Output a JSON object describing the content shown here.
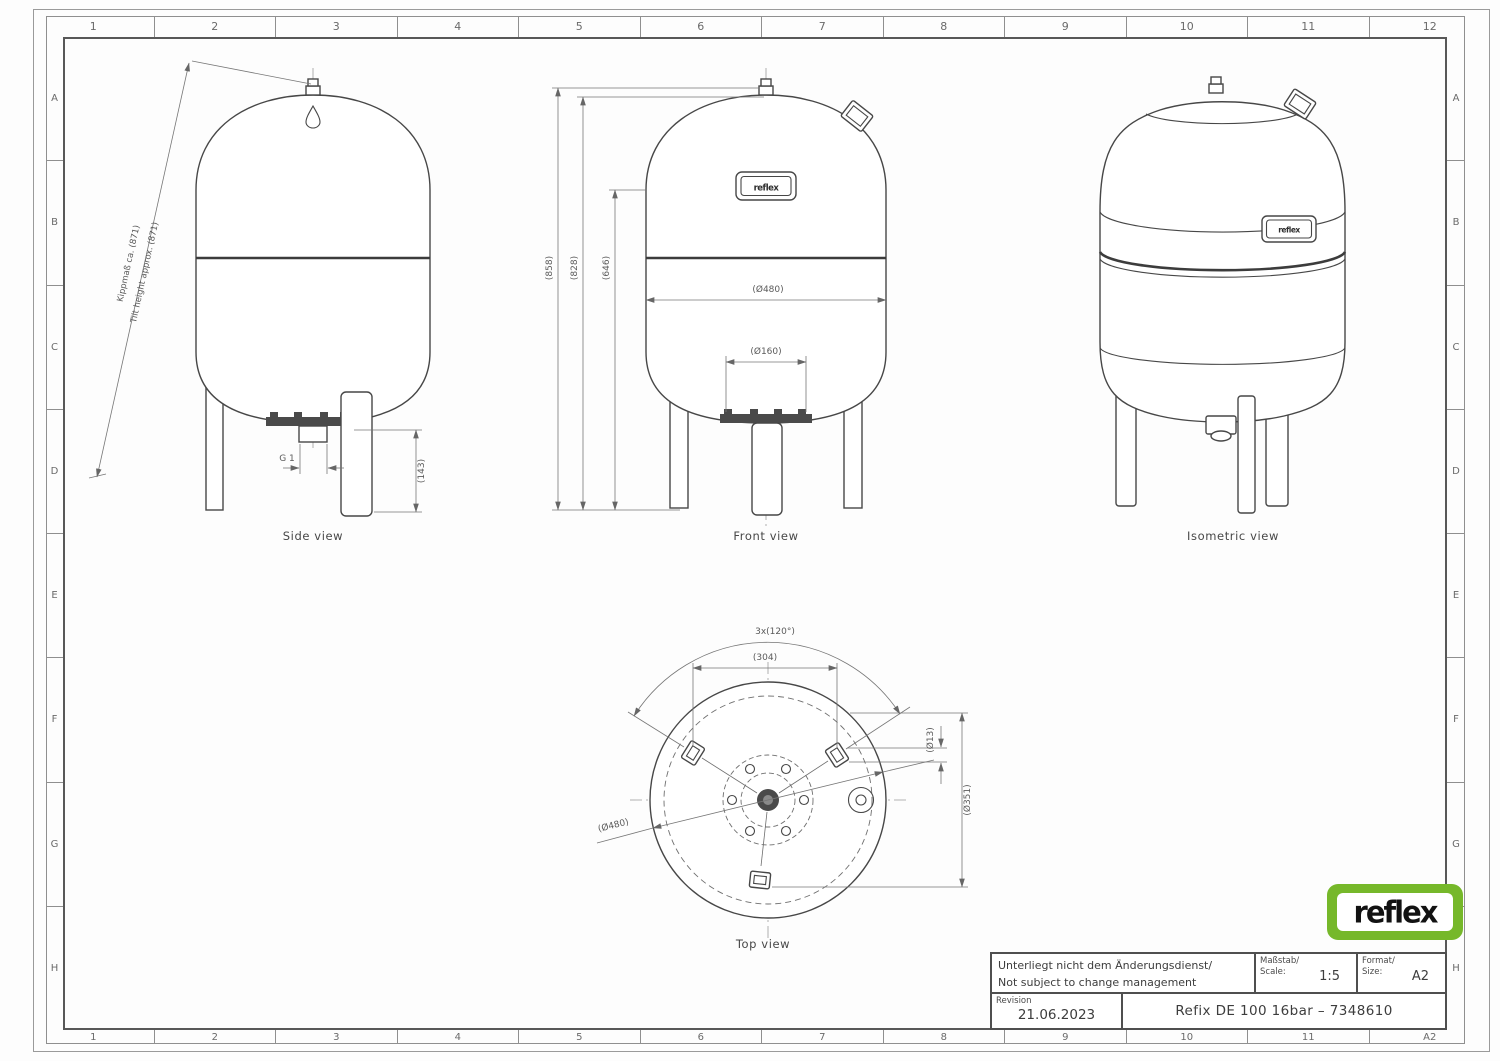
{
  "sheet": {
    "grid": {
      "top": [
        "1",
        "2",
        "3",
        "4",
        "5",
        "6",
        "7",
        "8",
        "9",
        "10",
        "11",
        "12"
      ],
      "bottom": [
        "1",
        "2",
        "3",
        "4",
        "5",
        "6",
        "7",
        "8",
        "9",
        "10",
        "11",
        "A2"
      ],
      "left": [
        "A",
        "B",
        "C",
        "D",
        "E",
        "F",
        "G",
        "H"
      ],
      "right": [
        "A",
        "B",
        "C",
        "D",
        "E",
        "F",
        "G",
        "H"
      ]
    },
    "views": {
      "side": {
        "caption": "Side view",
        "tilt_label_de": "Kippmaß ca. (871)",
        "tilt_label_en": "Tilt height approx. (871)",
        "thread_dim": "G 1",
        "leg_height_dim": "(143)"
      },
      "front": {
        "caption": "Front view",
        "total_height_dim": "(858)",
        "vessel_height_dim": "(828)",
        "lower_height_dim": "(646)",
        "diameter_dim": "(Ø480)",
        "base_diameter_dim": "(Ø160)",
        "plate_text": "reflex"
      },
      "isometric": {
        "caption": "Isometric view",
        "plate_text": "reflex"
      },
      "top": {
        "caption": "Top view",
        "feet_angle_dim": "3x(120°)",
        "feet_spacing_dim": "(304)",
        "hole_diameter_dim": "(Ø13)",
        "feet_circle_dim": "(Ø351)",
        "diameter_dim": "(Ø480)"
      }
    },
    "logo": {
      "text": "reflex"
    },
    "colors": {
      "logo_green": "#76b82a"
    },
    "title_block": {
      "note_de": "Unterliegt nicht dem Änderungsdienst/",
      "note_en": "Not subject to change management",
      "scale_label_de": "Maßstab/",
      "scale_label_en": "Scale:",
      "scale_value": "1:5",
      "format_label_de": "Format/",
      "format_label_en": "Size:",
      "format_value": "A2",
      "revision_label": "Revision",
      "revision_date": "21.06.2023",
      "drawing_title": "Refix DE 100 16bar – 7348610"
    }
  }
}
